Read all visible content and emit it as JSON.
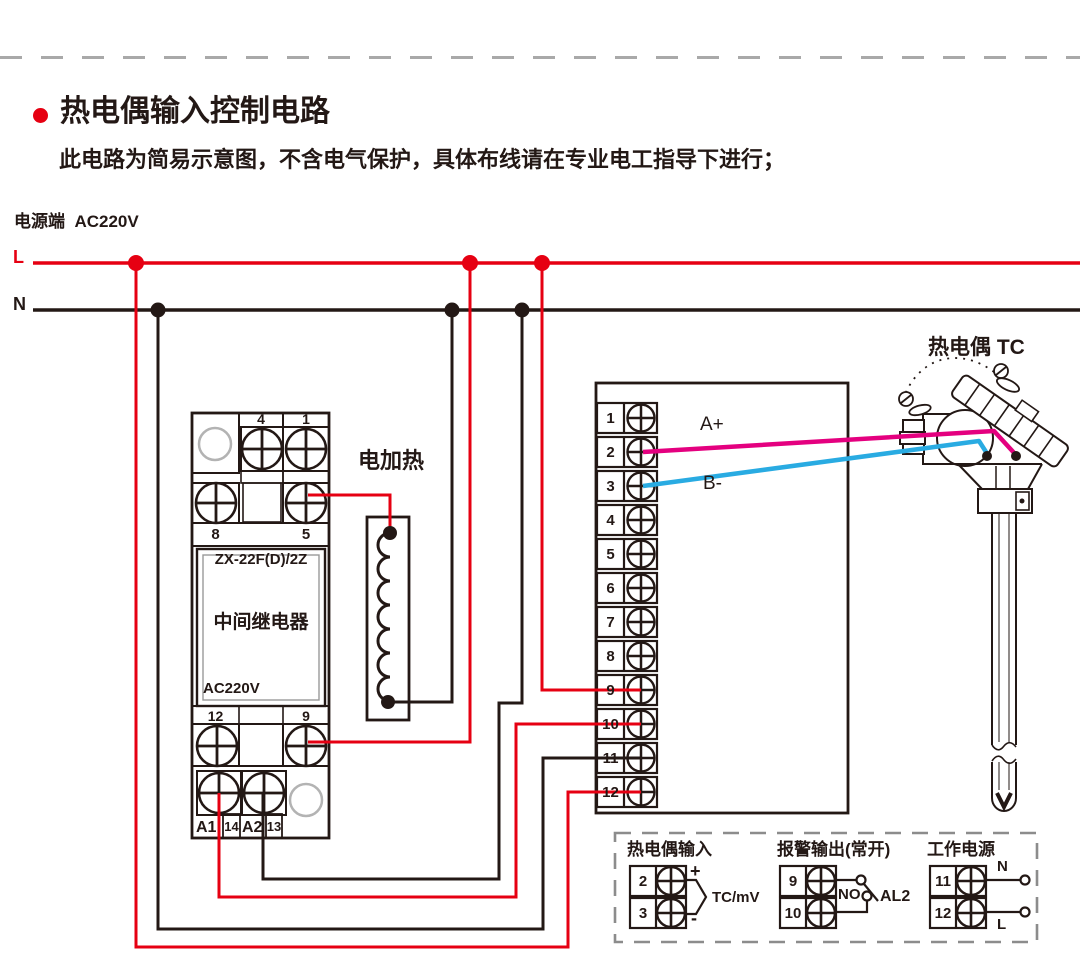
{
  "header": {
    "title": "热电偶输入控制电路",
    "subtitle": "此电路为简易示意图，不含电气保护，具体布线请在专业电工指导下进行；",
    "power_label": "电源端  AC220V",
    "l_label": "L",
    "n_label": "N"
  },
  "relay": {
    "model": "ZX-22F(D)/2Z",
    "name": "中间继电器",
    "voltage": "AC220V",
    "t4": "4",
    "t1": "1",
    "t8": "8",
    "t5": "5",
    "t12": "12",
    "t9": "9",
    "a1": "A1",
    "t14": "14",
    "a2": "A2",
    "t13": "13"
  },
  "heater": {
    "label": "电加热"
  },
  "instrument": {
    "terminals": [
      "1",
      "2",
      "3",
      "4",
      "5",
      "6",
      "7",
      "8",
      "9",
      "10",
      "11",
      "12"
    ],
    "wire_a_label": "A+",
    "wire_b_label": "B-"
  },
  "thermocouple": {
    "label": "热电偶 TC"
  },
  "legend": {
    "tc_input": {
      "title": "热电偶输入",
      "t2": "2",
      "t3": "3",
      "plus": "+",
      "minus": "-",
      "signal": "TC/mV"
    },
    "alarm": {
      "title": "报警输出(常开)",
      "t9": "9",
      "t10": "10",
      "no_label": "NO",
      "al2_label": "AL2"
    },
    "power": {
      "title": "工作电源",
      "t11": "11",
      "t12": "12",
      "n_label": "N",
      "l_label": "L"
    }
  },
  "colors": {
    "line_red": "#e60012",
    "line_black": "#231815",
    "wire_pink": "#e4007f",
    "wire_blue": "#29abe2"
  }
}
